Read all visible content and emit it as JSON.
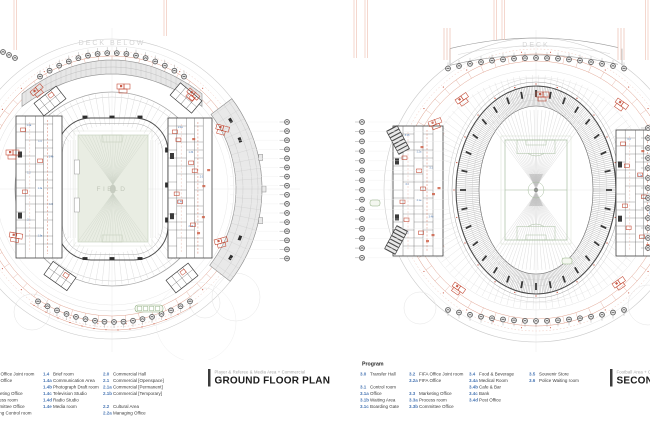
{
  "sheet": {
    "background": "#ffffff"
  },
  "colors": {
    "line_light": "#d6d6d6",
    "line_gray": "#a8a8a8",
    "dark": "#3a3a3a",
    "red": "#c0402a",
    "salmon": "#dc9a86",
    "pink": "#f0c6ba",
    "blue_label": "#3f6fae",
    "green_line": "#a9bfa1",
    "green_box": "#8fae80",
    "field_fill": "#e9ede3",
    "field_text": "#c1c7ba",
    "deck_text": "#d5d5d5",
    "seat_tick": "#b6b6b6",
    "deck_fill": "#e7e7e7"
  },
  "plans": {
    "left": {
      "deck_label": "DECK BELOW",
      "field_label": "FIELD",
      "title": {
        "category": "Player & Referee & Media Area + Commercial",
        "name": "GROUND FLOOR PLAN"
      },
      "annotation_numbers": [
        "1.4a",
        "1.4",
        "1.4b",
        "1.2",
        "1.2a",
        "1.3",
        "2.1",
        "1.3a",
        "2.1a",
        "1.3b",
        "2.0",
        "1.4c",
        "2.1b",
        "1.3c",
        "1.4d",
        "2.2"
      ]
    },
    "right": {
      "deck_label": "DECK",
      "title": {
        "category": "Football Area + Commercial",
        "name": "SECOND FLOOR PLAN"
      },
      "annotation_numbers": [
        "3.1b",
        "3.2a",
        "3.1",
        "3.3",
        "3.1a",
        "3.4b",
        "3.2",
        "3.4",
        "3.3a",
        "3.1c",
        "3.4a",
        "3.5",
        "3.3b",
        "3.6"
      ]
    }
  },
  "legends": {
    "left": {
      "columns": [
        {
          "items": [
            {
              "num": "1.2",
              "label": "FIFA Office Joint room"
            },
            {
              "num": "1.2a",
              "label": "FIFA Office"
            },
            {
              "num": "",
              "label": ""
            },
            {
              "num": "1.3",
              "label": "Marketing Office"
            },
            {
              "num": "1.3a",
              "label": "Process room"
            },
            {
              "num": "1.3b",
              "label": "Committee Office"
            },
            {
              "num": "1.3c",
              "label": "Doping Control room"
            }
          ]
        },
        {
          "items": [
            {
              "num": "1.4",
              "label": "Brief room"
            },
            {
              "num": "1.4a",
              "label": "Communication Area"
            },
            {
              "num": "1.4b",
              "label": "Photograph Draft room"
            },
            {
              "num": "1.4c",
              "label": "Television Studio"
            },
            {
              "num": "1.4d",
              "label": "Radio Studio"
            },
            {
              "num": "1.4e",
              "label": "Media room"
            }
          ]
        },
        {
          "items": [
            {
              "num": "2.0",
              "label": "Commercial Hall"
            },
            {
              "num": "2.1",
              "label": "Commercial [Openspace]"
            },
            {
              "num": "2.1a",
              "label": "Commercial [Permanent]"
            },
            {
              "num": "2.1b",
              "label": "Commercial [Temporary]"
            },
            {
              "num": "",
              "label": ""
            },
            {
              "num": "2.2",
              "label": "Cultural Area"
            },
            {
              "num": "2.2a",
              "label": "Managing Office"
            }
          ]
        }
      ]
    },
    "right": {
      "heading": "Program",
      "columns": [
        {
          "items": [
            {
              "num": "3.0",
              "label": "Transfer Hall"
            },
            {
              "num": "",
              "label": ""
            },
            {
              "num": "3.1",
              "label": "Control room"
            },
            {
              "num": "3.1a",
              "label": "Office"
            },
            {
              "num": "3.1b",
              "label": "Waiting Area"
            },
            {
              "num": "3.1c",
              "label": "Boarding Gate"
            }
          ]
        },
        {
          "items": [
            {
              "num": "3.2",
              "label": "FIFA Office Joint room"
            },
            {
              "num": "3.2a",
              "label": "FIFA Office"
            },
            {
              "num": "",
              "label": ""
            },
            {
              "num": "3.3",
              "label": "Marketing Office"
            },
            {
              "num": "3.3a",
              "label": "Process room"
            },
            {
              "num": "3.3b",
              "label": "Committee Office"
            }
          ]
        },
        {
          "items": [
            {
              "num": "3.4",
              "label": "Food & Beverage"
            },
            {
              "num": "3.4a",
              "label": "Medical Room"
            },
            {
              "num": "3.4b",
              "label": "Cafe & Bar"
            },
            {
              "num": "3.4c",
              "label": "Bank"
            },
            {
              "num": "3.4d",
              "label": "Post Office"
            }
          ]
        },
        {
          "items": [
            {
              "num": "3.5",
              "label": "Souvenir Store"
            },
            {
              "num": "3.6",
              "label": "Police Waiting room"
            }
          ]
        }
      ]
    }
  }
}
